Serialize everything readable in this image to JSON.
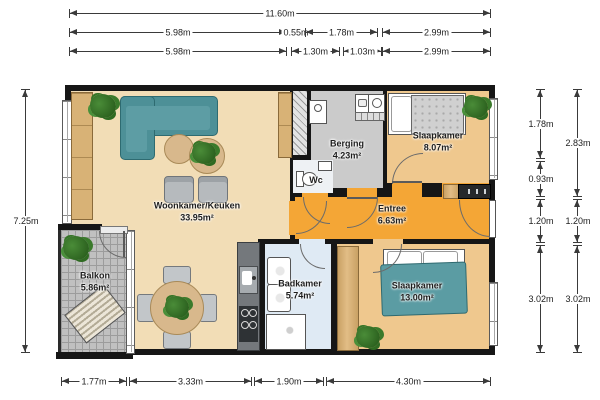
{
  "dims": {
    "t1": [
      "11.60m"
    ],
    "t2": [
      "5.98m",
      "0.55m",
      "1.78m",
      "2.99m"
    ],
    "t3": [
      "5.98m",
      "1.30m",
      "1.03m",
      "2.99m"
    ],
    "b": [
      "1.77m",
      "3.33m",
      "1.90m",
      "4.30m"
    ],
    "l": [
      "7.25m"
    ],
    "ri": [
      "1.78m",
      "0.93m",
      "1.20m",
      "3.02m"
    ],
    "ro": [
      "2.83m",
      "1.20m",
      "3.02m"
    ]
  },
  "rooms": {
    "woonkamer": {
      "name": "Woonkamer/Keuken",
      "area": "33.95m²"
    },
    "berging": {
      "name": "Berging",
      "area": "4.23m²"
    },
    "wc": {
      "name": "Wc"
    },
    "slaapkamer_boven": {
      "name": "Slaapkamer",
      "area": "8.07m²"
    },
    "entree": {
      "name": "Entree",
      "area": "6.63m²"
    },
    "badkamer": {
      "name": "Badkamer",
      "area": "5.74m²"
    },
    "slaapkamer_onder": {
      "name": "Slaapkamer",
      "area": "13.00m²"
    },
    "balkon": {
      "name": "Balkon",
      "area": "5.86m²"
    }
  },
  "colors": {
    "wall": "#161616",
    "living_floor": "#f2ddb6",
    "bedroom_floor": "#efc88e",
    "entree_floor": "#f4a636",
    "berging_floor": "#cbcbcb",
    "badkamer_floor": "#dfeaf4",
    "wc_floor": "#eef1f4",
    "balkon_floor": "#c0c0c0",
    "sofa": "#4d9097",
    "bed_blanket": "#5b9ca3",
    "wood": "#d5ac74",
    "kitchen_counter": "#74787c",
    "plant": "#3c7b2d"
  },
  "icons": {
    "plant": "leaf-cluster (css blob)",
    "door": "quarter-circle arc",
    "window": "white band with mullions"
  }
}
